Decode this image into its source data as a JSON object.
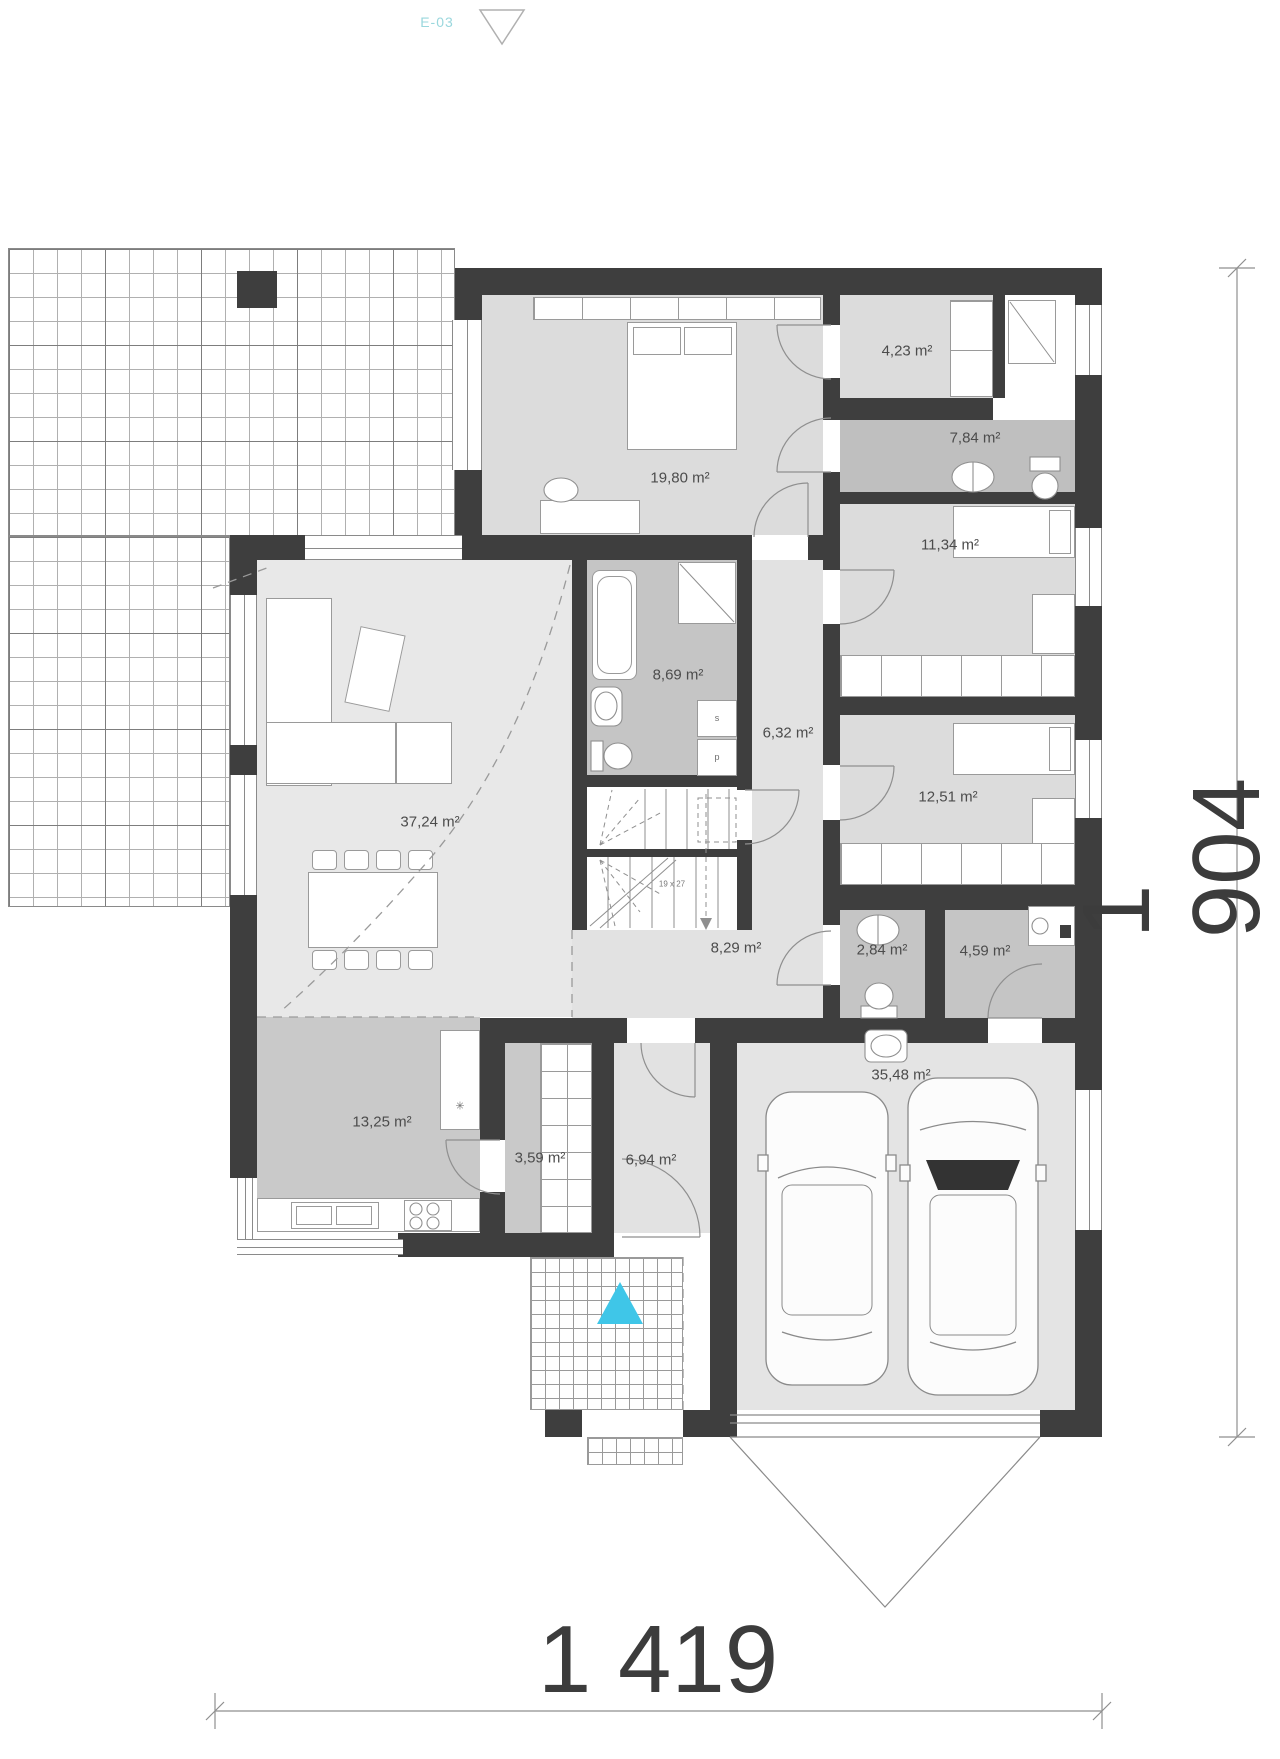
{
  "sheet": {
    "marker": "E-03"
  },
  "dimensions": {
    "bottom": "1 419",
    "right": "1 904"
  },
  "stairs": {
    "note": "19 x 27"
  },
  "appliances": {
    "dryer_label": "s",
    "washer_label": "p",
    "fridge_label": "✳"
  },
  "rooms": [
    {
      "name": "bedroom-main",
      "area": "19,80 m²"
    },
    {
      "name": "walk-in-closet",
      "area": "4,23 m²"
    },
    {
      "name": "bathroom-ensuite",
      "area": "7,84 m²"
    },
    {
      "name": "bedroom-east-1",
      "area": "11,34 m²"
    },
    {
      "name": "bathroom-central",
      "area": "8,69 m²"
    },
    {
      "name": "laundry",
      "area": "6,32 m²"
    },
    {
      "name": "bedroom-east-2",
      "area": "12,51 m²"
    },
    {
      "name": "living-room",
      "area": "37,24 m²"
    },
    {
      "name": "hall",
      "area": "8,29 m²"
    },
    {
      "name": "wc",
      "area": "2,84 m²"
    },
    {
      "name": "utility-room",
      "area": "4,59 m²"
    },
    {
      "name": "kitchen",
      "area": "13,25 m²"
    },
    {
      "name": "pantry",
      "area": "3,59 m²"
    },
    {
      "name": "entry",
      "area": "6,94 m²"
    },
    {
      "name": "garage",
      "area": "35,48 m²"
    }
  ],
  "colors": {
    "wall": "#3e3e3e",
    "accent_cyan": "#3fc6e8",
    "marker_text": "#9ad7dd"
  }
}
